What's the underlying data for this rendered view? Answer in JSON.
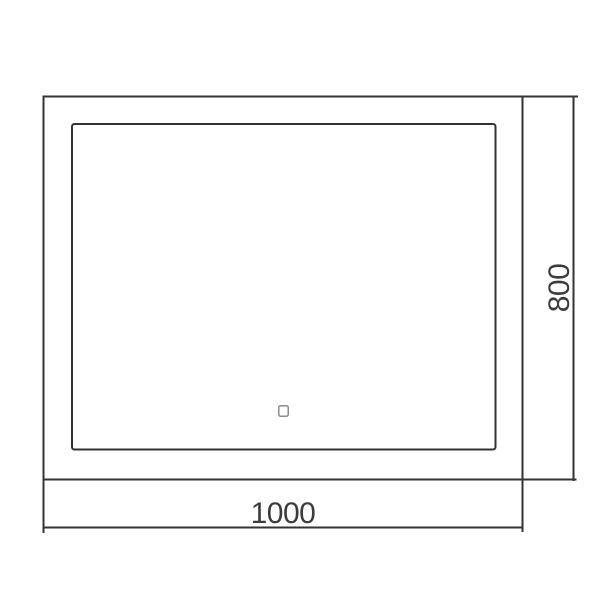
{
  "drawing": {
    "type": "technical-dimension-drawing",
    "subject": "rectangular mirror with touch sensor, front view",
    "dimensions": {
      "width_label": "1000",
      "height_label": "800"
    },
    "icons": {
      "touch_sensor": "touch-sensor-square"
    },
    "colors": {
      "line": "#333333",
      "text": "#3c3c3c",
      "sensor_outline": "#8a8a8a",
      "background": "#ffffff"
    }
  }
}
